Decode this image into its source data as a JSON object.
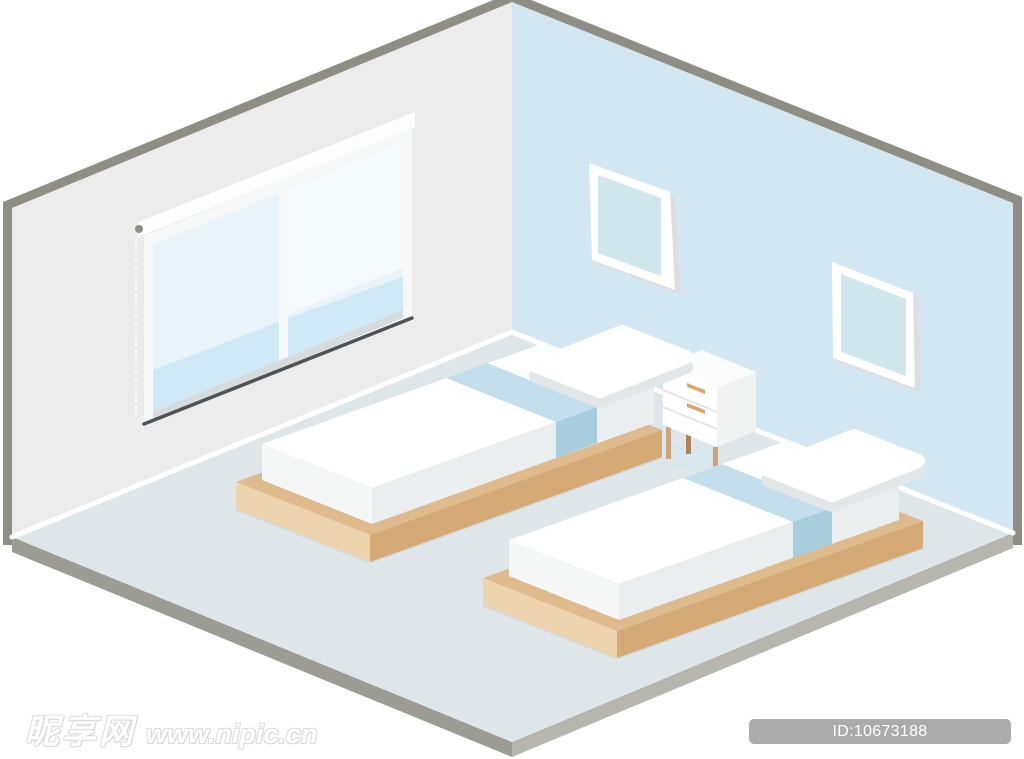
{
  "watermark": {
    "site_name": "昵享网",
    "site_url": "www.nipic.cn"
  },
  "badge": {
    "text": "ID:10673188 NO:20250811133333636105"
  },
  "colors": {
    "trim": "#8e8e85",
    "wall_left": "#ececec",
    "wall_right": "#d3e7f3",
    "floor": "#dfe6e9",
    "floor_side_left": "#9c9c94",
    "floor_side_right": "#b6b6ae",
    "baseboard": "#ffffff",
    "window_frame": "#f7f8f8",
    "blind": "#fdfdfd",
    "glass": "#e9f4fa",
    "glass_band": "#cfe9f6",
    "window_shade": "#d7dbdd",
    "sill": "#4e5254",
    "frame_white": "#ffffff",
    "frame_inner": "#cfe6ec",
    "frame_shadow": "#dddddd",
    "wood_top": "#deba8d",
    "wood_light": "#edd4ae",
    "wood_dark": "#d5aa77",
    "mattress_top": "#ffffff",
    "mattress_side": "#f5f6f6",
    "mattress_front": "#ebeeee",
    "stripe_top": "#c3dfee",
    "stripe_side": "#a8cede",
    "pillow": "#ffffff",
    "pillow_shadow": "#e2e6e8",
    "nightstand": "#ffffff",
    "nightstand_top": "#fcfcfc",
    "nightstand_side": "#f1f2f2",
    "handle": "#d9a770",
    "leg": "#cfa377",
    "leg_dark": "#ad8257",
    "shadow_blue": "#d6e6ef",
    "badge_bg": "#ababab",
    "badge_text": "#ffffff",
    "watermark_text": "#ffffff"
  }
}
